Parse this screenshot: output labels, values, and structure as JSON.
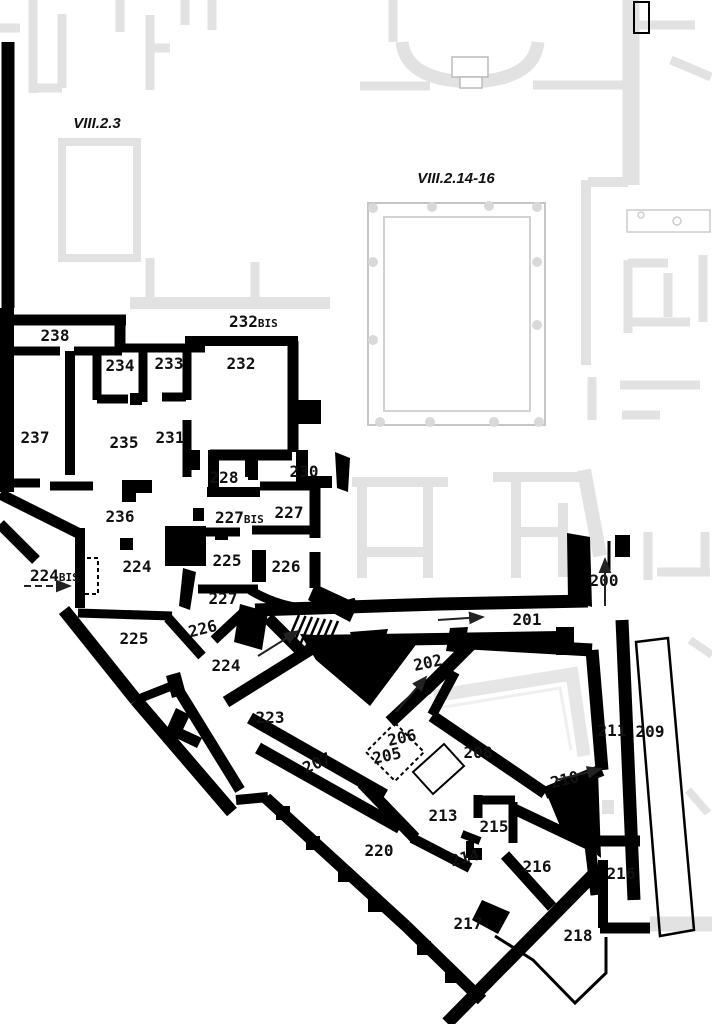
{
  "plan": {
    "title": "Pompeii insula floor plan",
    "area_labels": [
      {
        "id": "area-viii-2-3",
        "text": "VIII.2.3",
        "x": 97,
        "y": 128,
        "size": 15
      },
      {
        "id": "area-viii-2-14-16",
        "text": "VIII.2.14-16",
        "x": 456,
        "y": 183,
        "size": 15
      }
    ],
    "room_labels": [
      {
        "num": "238",
        "x": 55,
        "y": 341
      },
      {
        "num": "234",
        "x": 120,
        "y": 371
      },
      {
        "num": "233",
        "x": 169,
        "y": 369
      },
      {
        "num": "232",
        "x": 241,
        "y": 369
      },
      {
        "num": "232",
        "suffix": "BIS",
        "x": 229,
        "y": 327,
        "anchor": "start"
      },
      {
        "num": "237",
        "x": 35,
        "y": 443
      },
      {
        "num": "235",
        "x": 124,
        "y": 448
      },
      {
        "num": "231",
        "x": 170,
        "y": 443
      },
      {
        "num": "228",
        "x": 224,
        "y": 483
      },
      {
        "num": "230",
        "x": 304,
        "y": 477
      },
      {
        "num": "236",
        "x": 120,
        "y": 522
      },
      {
        "num": "227",
        "suffix": "BIS",
        "x": 215,
        "y": 523,
        "anchor": "start"
      },
      {
        "num": "227",
        "x": 289,
        "y": 518
      },
      {
        "num": "224",
        "suffix": "BIS",
        "x": 30,
        "y": 581,
        "anchor": "start"
      },
      {
        "num": "224",
        "x": 137,
        "y": 572
      },
      {
        "num": "225",
        "x": 227,
        "y": 566
      },
      {
        "num": "226",
        "x": 286,
        "y": 572
      },
      {
        "num": "227",
        "x": 223,
        "y": 604
      },
      {
        "num": "226",
        "x": 204,
        "y": 634,
        "rot": -14
      },
      {
        "num": "225",
        "x": 134,
        "y": 644
      },
      {
        "num": "224",
        "x": 226,
        "y": 671
      },
      {
        "num": "223",
        "x": 270,
        "y": 723
      },
      {
        "num": "207",
        "x": 319,
        "y": 768,
        "rot": -24
      },
      {
        "num": "206",
        "x": 403,
        "y": 743,
        "rot": -12
      },
      {
        "num": "205",
        "x": 388,
        "y": 761,
        "rot": -12
      },
      {
        "num": "202",
        "x": 429,
        "y": 668,
        "rot": -12
      },
      {
        "num": "208",
        "x": 478,
        "y": 758
      },
      {
        "num": "201",
        "x": 527,
        "y": 625
      },
      {
        "num": "200",
        "x": 604,
        "y": 586
      },
      {
        "num": "211",
        "x": 612,
        "y": 736
      },
      {
        "num": "209",
        "x": 650,
        "y": 737
      },
      {
        "num": "210",
        "x": 566,
        "y": 785,
        "rot": -14
      },
      {
        "num": "213",
        "x": 443,
        "y": 821
      },
      {
        "num": "215",
        "x": 494,
        "y": 832
      },
      {
        "num": "214",
        "x": 466,
        "y": 863,
        "rot": -14
      },
      {
        "num": "216",
        "x": 537,
        "y": 872
      },
      {
        "num": "216",
        "x": 621,
        "y": 879
      },
      {
        "num": "217",
        "x": 468,
        "y": 929
      },
      {
        "num": "218",
        "x": 578,
        "y": 941
      },
      {
        "num": "220",
        "x": 379,
        "y": 856
      }
    ],
    "arrows": [
      {
        "x1": 24,
        "y1": 586,
        "x2": 70,
        "y2": 586,
        "dashed": true
      },
      {
        "x1": 258,
        "y1": 656,
        "x2": 298,
        "y2": 631
      },
      {
        "x1": 396,
        "y1": 712,
        "x2": 426,
        "y2": 677
      },
      {
        "x1": 438,
        "y1": 620,
        "x2": 483,
        "y2": 617
      },
      {
        "x1": 605,
        "y1": 606,
        "x2": 605,
        "y2": 559
      },
      {
        "x1": 556,
        "y1": 780,
        "x2": 601,
        "y2": 769
      }
    ],
    "colors": {
      "walls": "#000000",
      "background_plan": "#e2e2e2",
      "paper": "#ffffff",
      "labels": "#111111"
    }
  }
}
